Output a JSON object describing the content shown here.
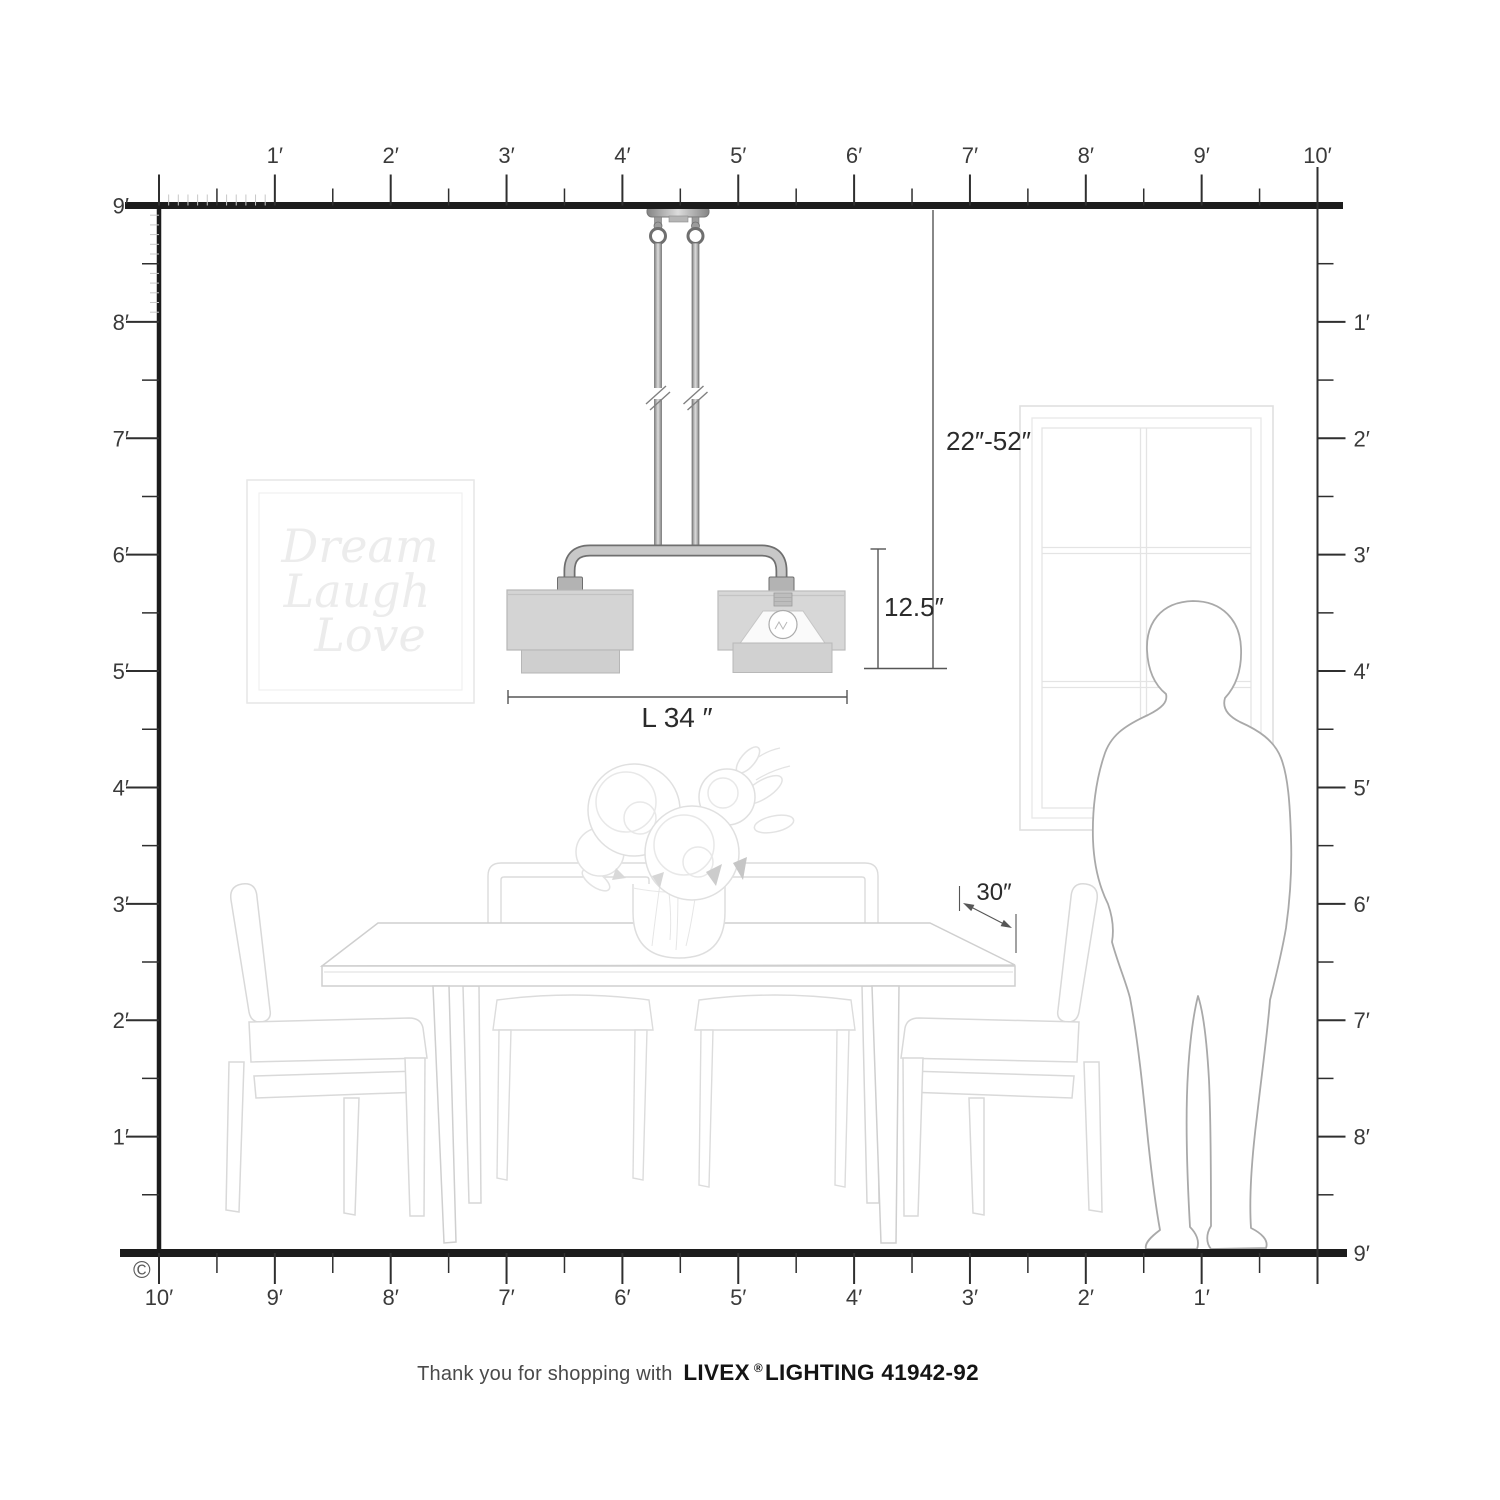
{
  "colors": {
    "ink": "#1c1c1c",
    "tick": "#2f2f2f",
    "label": "#3a3a3a",
    "inch_tick": "#c7c7c7",
    "dim_line": "#565656",
    "dim_text": "#2b2b2b",
    "furniture": "#dadada",
    "furniture_light": "#e4e4e4",
    "person_outline": "#a9a9a9",
    "metal_dark": "#6f6f6f",
    "metal_light": "#c8c8c8",
    "shade_fill": "#d4d4d4",
    "shade_stroke": "#b6b6b6",
    "art_text": "#ececec",
    "caption_text": "#4a4a4a",
    "brand_text": "#141414"
  },
  "rulers": {
    "top": [
      "1′",
      "2′",
      "3′",
      "4′",
      "5′",
      "6′",
      "7′",
      "8′",
      "9′",
      "10′"
    ],
    "left": [
      "9′",
      "8′",
      "7′",
      "6′",
      "5′",
      "4′",
      "3′",
      "2′",
      "1′"
    ],
    "right": [
      "1′",
      "2′",
      "3′",
      "4′",
      "5′",
      "6′",
      "7′",
      "8′",
      "9′"
    ],
    "bottom": [
      "10′",
      "9′",
      "8′",
      "7′",
      "6′",
      "5′",
      "4′",
      "3′",
      "2′",
      "1′"
    ]
  },
  "dimensions": {
    "hanging_height": "22″-52″",
    "fixture_height": "12.5″",
    "fixture_length": "L 34 ″",
    "table_depth": "30″"
  },
  "wall_art": {
    "line1": "Dream",
    "line2": "Laugh",
    "line3": "Love"
  },
  "footer": {
    "message": "Thank you for shopping with",
    "brand": "LIVEX",
    "registered": "®",
    "product": "LIGHTING 41942-92"
  },
  "copyright_symbol": "©"
}
